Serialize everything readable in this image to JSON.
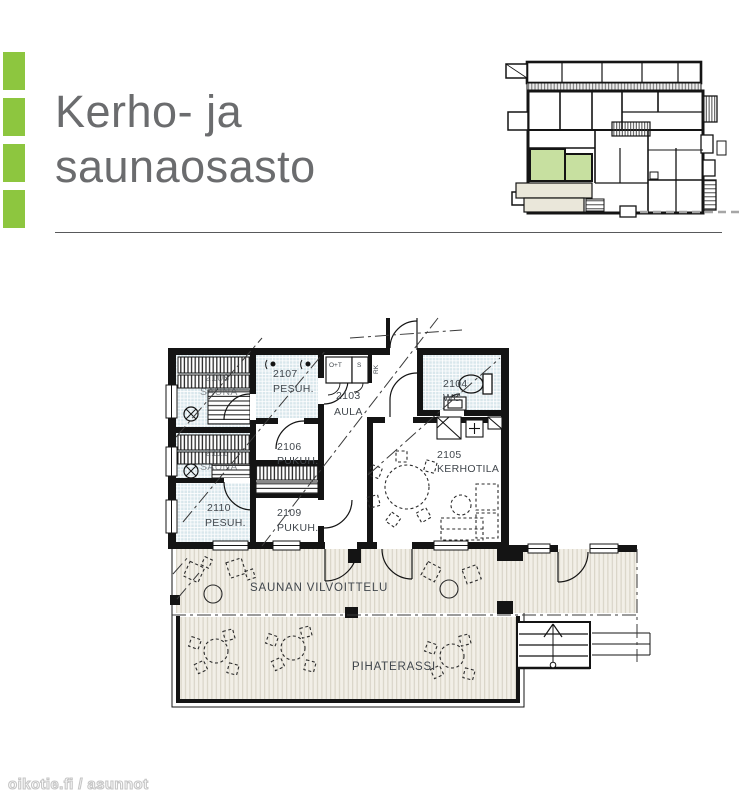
{
  "theme": {
    "accent_green": "#8dc63f",
    "title_color": "#6b6c6e",
    "divider_color": "#58595b",
    "minimap_highlight": "#c7e0a0",
    "minimap_terrace": "#eae7da",
    "tile_blue": "#d9e7ec",
    "deck_cream": "#f2efe7",
    "wall_color": "#141414",
    "label_color": "#41474d"
  },
  "header": {
    "title_line1": "Kerho- ja",
    "title_line2": "saunaosasto"
  },
  "floorplan": {
    "rooms": [
      {
        "number": "2108",
        "name": "SAUNA"
      },
      {
        "number": "2107",
        "name": "PESUH."
      },
      {
        "number": "2103",
        "name": "AULA"
      },
      {
        "number": "2104",
        "name": "WC"
      },
      {
        "number": "2105",
        "name": "KERHOTILA"
      },
      {
        "number": "2106",
        "name": "PUKUH."
      },
      {
        "number": "2111",
        "name": "SAUNA"
      },
      {
        "number": "2110",
        "name": "PESUH."
      },
      {
        "number": "2109",
        "name": "PUKUH."
      }
    ],
    "area_labels": {
      "vilvoittelu": "SAUNAN VILVOITTELU",
      "terrace": "PIHATERASSI"
    },
    "small_labels": {
      "closet1": "O+T",
      "closet2": "S",
      "riser": "RK"
    }
  },
  "watermark": {
    "text": "oikotie.fi / asunnot"
  }
}
